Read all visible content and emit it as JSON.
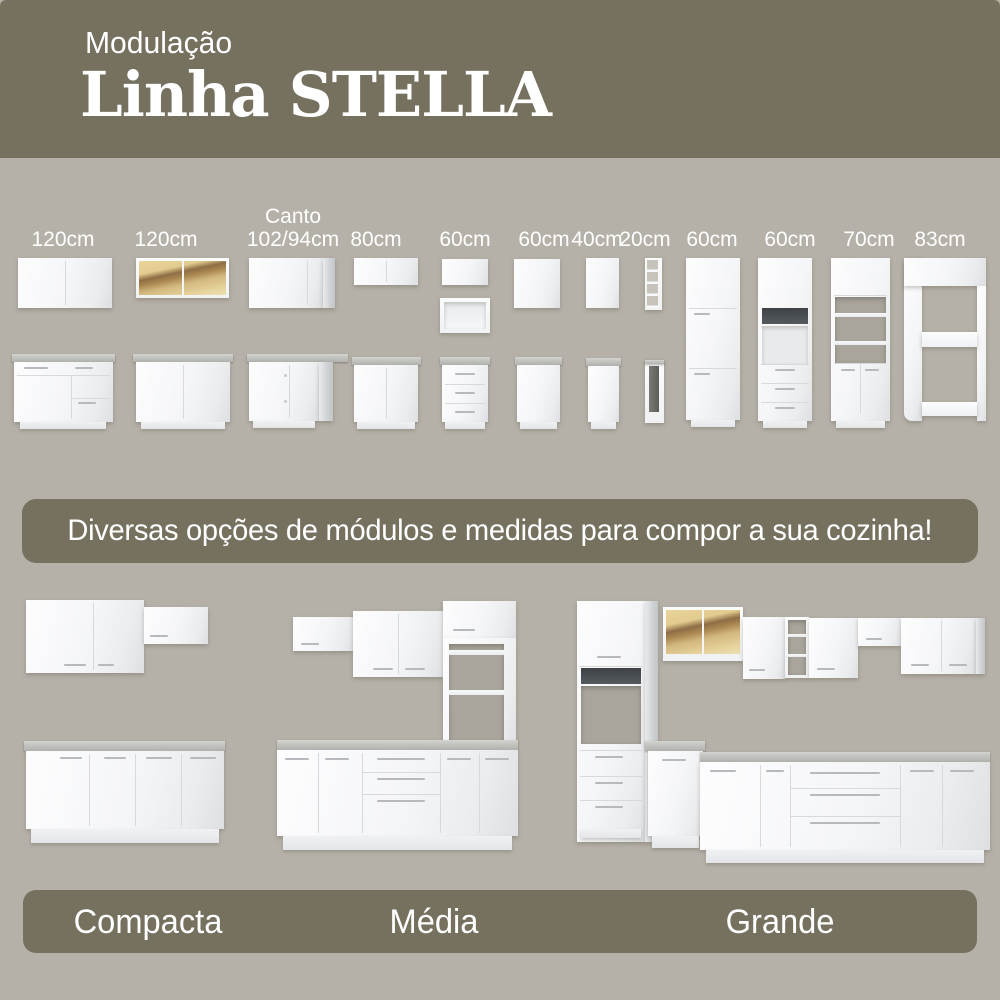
{
  "header": {
    "eyebrow": "Modulação",
    "title": "Linha STELLA"
  },
  "modules": {
    "labels": [
      {
        "label": "120cm"
      },
      {
        "label": "120cm"
      },
      {
        "label": "Canto",
        "label2": "102/94cm"
      },
      {
        "label": "80cm"
      },
      {
        "label": "60cm"
      },
      {
        "label": "60cm"
      },
      {
        "label": "40cm"
      },
      {
        "label": "20cm"
      },
      {
        "label": "60cm"
      },
      {
        "label": "60cm"
      },
      {
        "label": "70cm"
      },
      {
        "label": "83cm"
      }
    ]
  },
  "banner": {
    "text": "Diversas opções de módulos e medidas para compor a sua cozinha!"
  },
  "kitchens": [
    {
      "name": "Compacta"
    },
    {
      "name": "Média"
    },
    {
      "name": "Grande"
    }
  ],
  "colors": {
    "accent_band": "#76705F",
    "background": "#B5B1A8",
    "cabinet_white": "#F4F5F7",
    "countertop_gray": "#C2C3BF",
    "glass_amber": "#D9BE84"
  }
}
